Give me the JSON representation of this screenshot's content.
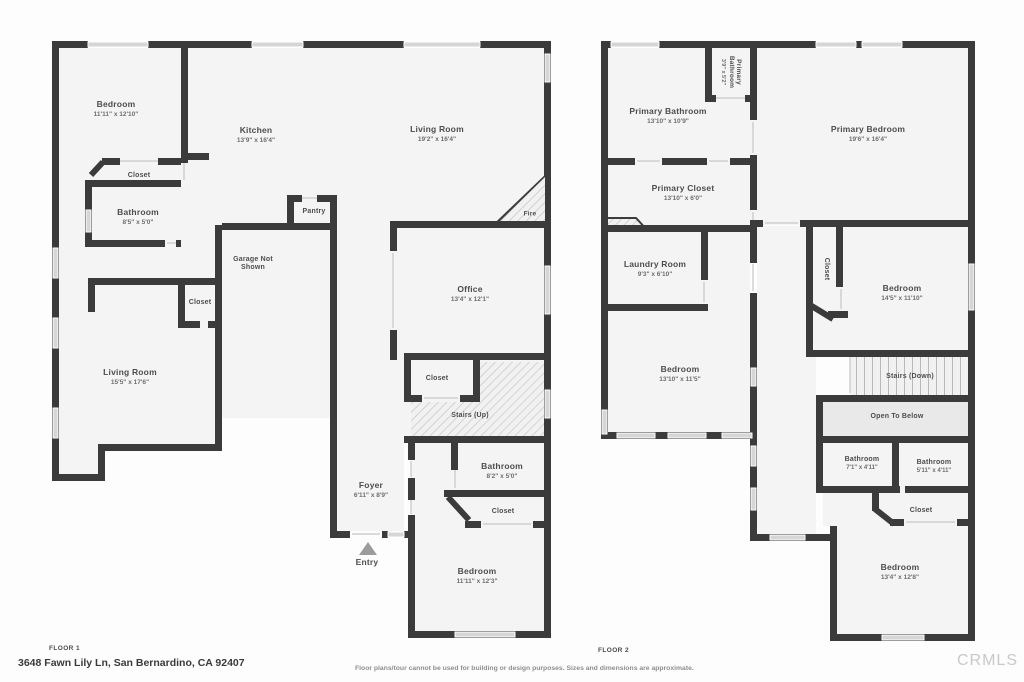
{
  "floor1": {
    "label": "FLOOR 1",
    "rooms": {
      "bedroom_top": {
        "name": "Bedroom",
        "dims": "11'11\" x 12'10\""
      },
      "kitchen": {
        "name": "Kitchen",
        "dims": "13'9\" x 16'4\""
      },
      "living_room": {
        "name": "Living Room",
        "dims": "19'2\" x 16'4\""
      },
      "closet_bedroom": {
        "name": "Closet"
      },
      "bathroom_top": {
        "name": "Bathroom",
        "dims": "8'5\" x 5'0\""
      },
      "pantry": {
        "name": "Pantry"
      },
      "garage": {
        "name": "Garage Not",
        "name2": "Shown"
      },
      "closet_hall": {
        "name": "Closet"
      },
      "living_room_2": {
        "name": "Living Room",
        "dims": "15'5\" x 17'6\""
      },
      "office": {
        "name": "Office",
        "dims": "13'4\" x 12'1\""
      },
      "closet_stairs": {
        "name": "Closet"
      },
      "stairs_up": {
        "name": "Stairs (Up)"
      },
      "foyer": {
        "name": "Foyer",
        "dims": "6'11\" x 8'9\""
      },
      "entry": {
        "name": "Entry"
      },
      "bathroom_lower": {
        "name": "Bathroom",
        "dims": "8'2\" x 5'0\""
      },
      "closet_lower": {
        "name": "Closet"
      },
      "bedroom_lower": {
        "name": "Bedroom",
        "dims": "11'11\" x 12'3\""
      },
      "fireplace": {
        "name": "Fire"
      }
    }
  },
  "floor2": {
    "label": "FLOOR 2",
    "rooms": {
      "primary_bathroom": {
        "name": "Primary Bathroom",
        "dims": "13'10\" x 10'9\""
      },
      "primary_bathroom_small": {
        "name": "Primary",
        "name2": "Bathroom",
        "dims": "3'9\" x 5'2\""
      },
      "primary_bedroom": {
        "name": "Primary Bedroom",
        "dims": "19'6\" x 16'4\""
      },
      "primary_closet": {
        "name": "Primary Closet",
        "dims": "13'10\" x 6'0\""
      },
      "laundry": {
        "name": "Laundry Room",
        "dims": "9'3\" x 6'10\""
      },
      "closet_mid": {
        "name": "Closet"
      },
      "bedroom_mid": {
        "name": "Bedroom",
        "dims": "14'5\" x 11'10\""
      },
      "bedroom_left": {
        "name": "Bedroom",
        "dims": "13'10\" x 11'5\""
      },
      "stairs_down": {
        "name": "Stairs (Down)"
      },
      "open_below": {
        "name": "Open To Below"
      },
      "bathroom_a": {
        "name": "Bathroom",
        "dims": "7'1\" x 4'11\""
      },
      "bathroom_b": {
        "name": "Bathroom",
        "dims": "5'11\" x 4'11\""
      },
      "closet_low": {
        "name": "Closet"
      },
      "bedroom_low": {
        "name": "Bedroom",
        "dims": "13'4\" x 12'8\""
      }
    }
  },
  "footer": {
    "address": "3648 Fawn Lily Ln, San Bernardino, CA 92407",
    "disclaimer": "Floor plans/tour cannot be used for building or design purposes. Sizes and dimensions are approximate.",
    "brand": "CRMLS"
  },
  "colors": {
    "wall": "#3b3b3b",
    "floor": "#f4f4f4",
    "window": "#d6d6d6",
    "open_to_below": "#e9e9e9"
  }
}
